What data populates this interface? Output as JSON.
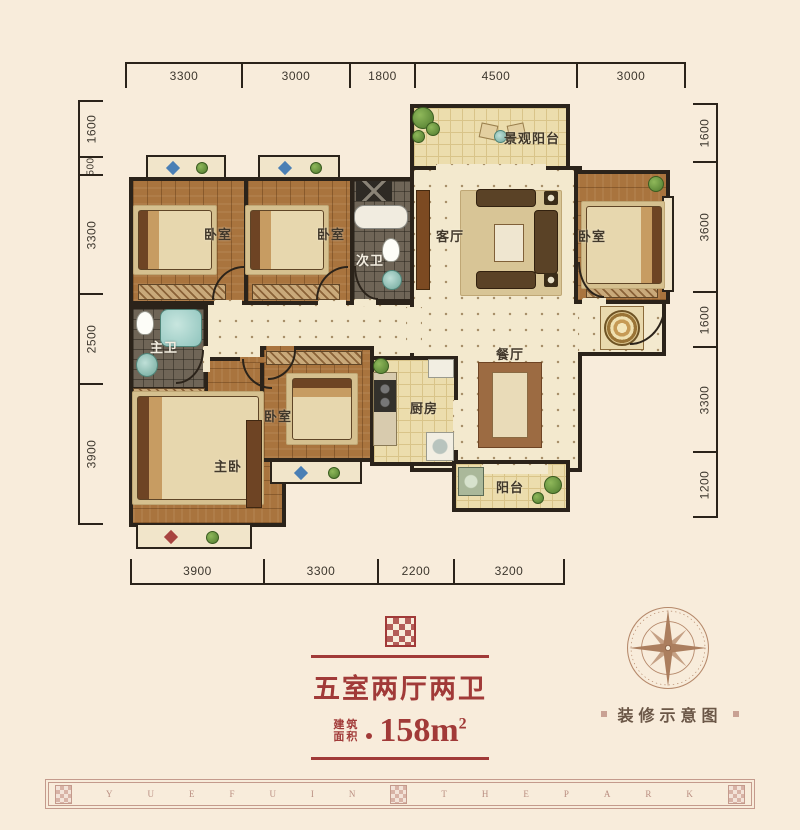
{
  "dimensions": {
    "top": [
      "3300",
      "3000",
      "1800",
      "4500",
      "3000"
    ],
    "left": [
      "1600",
      "500",
      "3300",
      "2500",
      "3900"
    ],
    "right": [
      "1600",
      "3600",
      "1600",
      "3300",
      "1200"
    ],
    "bottom": [
      "3900",
      "3300",
      "2200",
      "3200"
    ]
  },
  "rooms": {
    "view_balcony": {
      "label": "景观阳台"
    },
    "living_room": {
      "label": "客厅"
    },
    "bedroom_top_left": {
      "label": "卧室"
    },
    "bedroom_top_mid": {
      "label": "卧室"
    },
    "second_bath": {
      "label": "次卫"
    },
    "bedroom_right": {
      "label": "卧室"
    },
    "master_bath": {
      "label": "主卫"
    },
    "master_bedroom": {
      "label": "主卧"
    },
    "bedroom_small": {
      "label": "卧室"
    },
    "kitchen": {
      "label": "厨房"
    },
    "dining_room": {
      "label": "餐厅"
    },
    "balcony": {
      "label": "阳台"
    }
  },
  "title_block": {
    "title": "五室两厅两卫",
    "area_label_line1": "建筑",
    "area_label_line2": "面积",
    "area_value": "158m",
    "area_superscript": "2"
  },
  "legend": {
    "caption": "装修示意图"
  },
  "footer": {
    "letters": [
      "Y",
      "U",
      "E",
      "F",
      "U",
      "I",
      "N",
      "T",
      "H",
      "E",
      "P",
      "A",
      "R",
      "K"
    ]
  },
  "colors": {
    "accent_red": "#A13A38",
    "wall_dark": "#2B231A",
    "background_cream": "#F8ECDB",
    "footer_rose": "#C49A8C"
  }
}
